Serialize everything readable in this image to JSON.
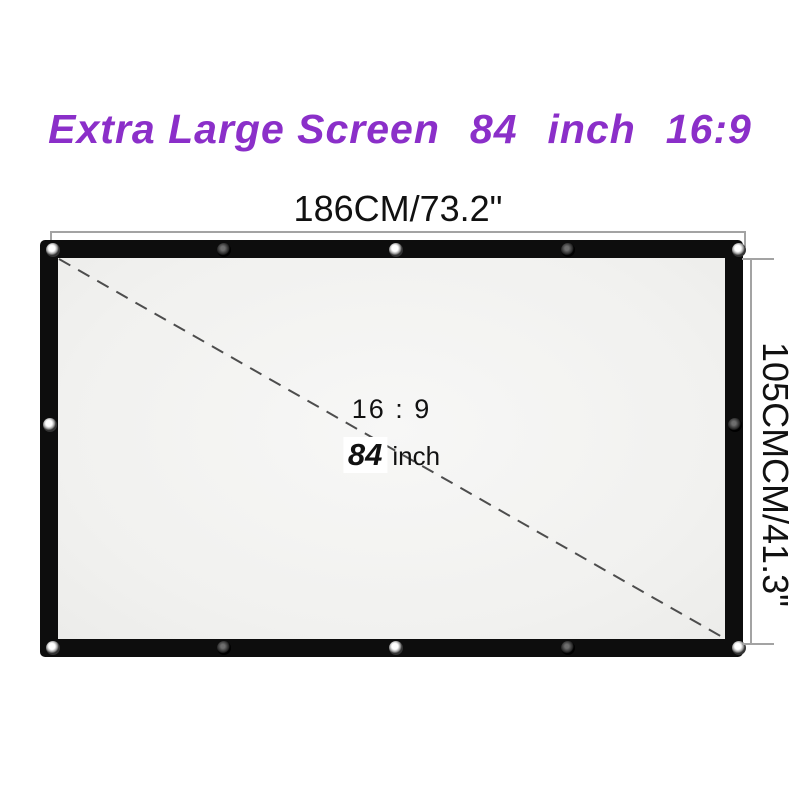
{
  "colors": {
    "accent": "#8B2FC9",
    "text": "#111111",
    "dim-line": "#a3a3a3",
    "screen-border": "#0d0d0d",
    "screen-surface": "#f3f3f1",
    "diagonal": "#4d4d4d"
  },
  "title": {
    "main": "Extra Large Screen",
    "size_value": "84",
    "size_unit": "inch",
    "aspect_ratio": "16:9"
  },
  "dimensions": {
    "width_label": "186CM/73.2\"",
    "height_label": "105CMCM/41.3\""
  },
  "screen_labels": {
    "aspect_ratio": "16 : 9",
    "size_value": "84",
    "size_unit": "inch"
  }
}
